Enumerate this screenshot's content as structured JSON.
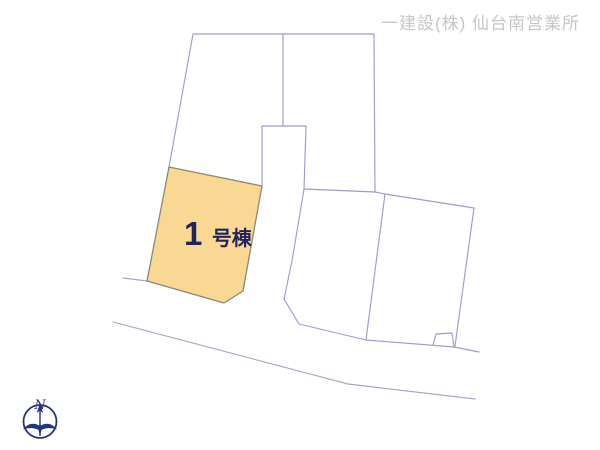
{
  "header": {
    "company_label": "一建設(株) 仙台南営業所"
  },
  "parcel": {
    "label_number": "1",
    "label_suffix": "号棟",
    "fill_color": "#f8d893",
    "stroke_color": "#8b8873",
    "label_text_color": "#23235c"
  },
  "map": {
    "boundary_line_color": "#9d9dcd",
    "road_line_color": "#a6a6c4",
    "header_text_color": "#c6c6c6"
  },
  "compass": {
    "north_label": "N",
    "color": "#25357d"
  }
}
